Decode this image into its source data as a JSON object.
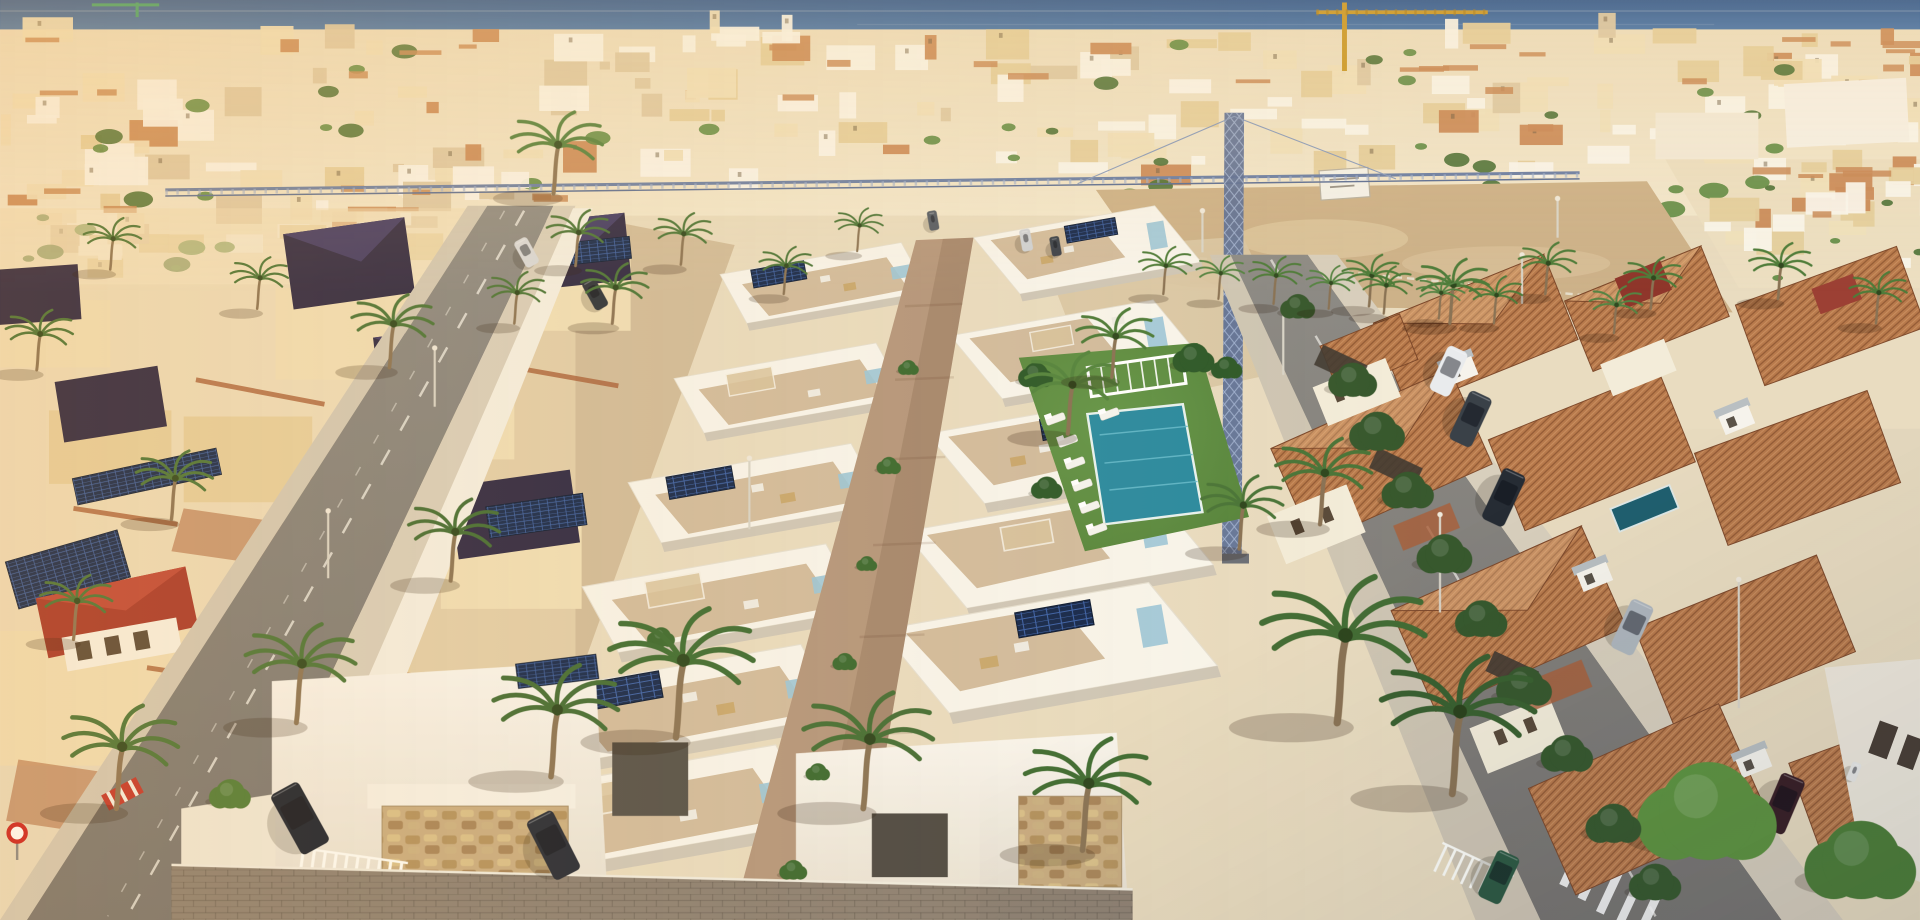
{
  "meta": {
    "kind": "aerial-architectural-render",
    "description": "Aerial drone view at golden hour of a new-build development of white modern townhouses with roof terraces, solar panels and a communal pool, flanked by an older district of cream villas with dark hip roofs on the left and Mediterranean villas with terracotta tiled roofs on the right; palm-lined streets, a sandy vacant lot with a tower crane, dense white town and the deep blue sea on the horizon.",
    "width": 1920,
    "height": 920
  },
  "palette": {
    "sea1": "#2b5793",
    "sea2": "#5082b8",
    "band1": "#ecdfc2",
    "band2": "#f2e7cd",
    "sand": "#cdb28a",
    "sand_light": "#dcc59e",
    "white_wall": "#f8f5ec",
    "shade_wall": "#cfc7b8",
    "cream": "#f0dfb8",
    "cream2": "#e6d0a0",
    "terrace_tan": "#d2bc9e",
    "path_tan": "#b5977d",
    "drive_tan": "#d9c6a4",
    "lawn": "#54813a",
    "lawn_light": "#66974a",
    "pool": "#2c8ba0",
    "pool_ripple": "#67bccd",
    "pool_private": "#20606f",
    "glass_blue": "#9cc6d8",
    "solar": "#16294d",
    "solar_grid": "#3d62a8",
    "roof_navy": "#2d2845",
    "roof_navy_hi": "#413a66",
    "roof_red": "#a8392d",
    "roof_terra": "#b87a4c",
    "roof_terra_dark": "#7e4a2c",
    "gable_red": "#8f362b",
    "asphalt": "#8d8b86",
    "asphalt_dark": "#787571",
    "sidewalk": "#d2c9b7",
    "sidewalk2": "#d8cfbd",
    "stone": "#c9ad82",
    "brick": "#a9603a",
    "palm_trunk": "#8a7355",
    "crane_blue": "#5c6f96",
    "crane_lattice": "#9fb0cf",
    "crane_yellow": "#c9992a",
    "paver": "#8d8174",
    "sign_red": "#cc2222"
  },
  "scene": {
    "objects": [
      "sea-horizon",
      "distant-town",
      "tower-crane",
      "sandy-vacant-lot",
      "left-villa-district",
      "left-street",
      "new-development-row-west",
      "new-development-row-east",
      "central-walkway",
      "communal-garden",
      "swimming-pool",
      "pergola",
      "sun-loungers",
      "right-street",
      "right-villa-district",
      "private-pool",
      "crosswalks",
      "parked-cars",
      "street-lamps",
      "palm-trees",
      "stone-clad-walls",
      "solar-panels"
    ],
    "distant_town": {
      "seed": 7,
      "bands": [
        {
          "x": 0,
          "w": 1568,
          "y": 26,
          "h": 130,
          "count": 150
        },
        {
          "x": 0,
          "w": 440,
          "y": 150,
          "h": 78,
          "count": 45
        },
        {
          "x": 1360,
          "w": 208,
          "y": 135,
          "h": 95,
          "count": 25
        }
      ],
      "colors": [
        [
          "#f9f5ec",
          0.38
        ],
        [
          "#efe0bd",
          0.24
        ],
        [
          "#e4cf9e",
          0.14
        ],
        [
          "#c98a5a",
          0.09
        ],
        [
          "#dcc9a6",
          0.15
        ]
      ],
      "green1": "#4a7036",
      "green2": "#5d8a43",
      "terra": "#c88a58"
    },
    "development": {
      "rows": [
        {
          "protos": [
            "unit-west-solar",
            "unit-west-plain"
          ],
          "start": [
            736,
            198
          ],
          "step": [
            -20.5,
            82
          ],
          "scale0": 1,
          "dscale": 0.115,
          "count": 6
        },
        {
          "protos": [
            "unit-east-solar",
            "unit-east-plain"
          ],
          "start": [
            795,
            194
          ],
          "step": [
            -19,
            80
          ],
          "scale0": 1,
          "dscale": 0.12,
          "count": 5
        }
      ]
    },
    "palms": [
      [
        552,
        602,
        1.5,
        "#3f6d33"
      ],
      [
        705,
        660,
        1.35,
        "#466f36"
      ],
      [
        884,
        694,
        1.3,
        "#3f6d33"
      ],
      [
        242,
        590,
        1.15,
        "#4a7539"
      ],
      [
        450,
        634,
        1.3,
        "#436d35"
      ],
      [
        95,
        660,
        1.2,
        "#4a7539"
      ],
      [
        452,
        158,
        0.95,
        "#52803f"
      ],
      [
        500,
        264,
        0.7,
        "#4a7539"
      ],
      [
        556,
        216,
        0.6,
        "#4a7539"
      ],
      [
        1092,
        590,
        1.7,
        "#436d35"
      ],
      [
        1186,
        648,
        1.6,
        "#3a6130"
      ],
      [
        1078,
        428,
        1.0,
        "#4a7539"
      ],
      [
        1012,
        448,
        0.85,
        "#4a7539"
      ],
      [
        872,
        354,
        0.95,
        "#55853f"
      ],
      [
        908,
        308,
        0.8,
        "#4e7c3a"
      ],
      [
        318,
        300,
        0.85,
        "#4a7539"
      ],
      [
        368,
        474,
        0.95,
        "#436d35"
      ],
      [
        140,
        424,
        0.8,
        "#4a7539"
      ],
      [
        60,
        522,
        0.75,
        "#4a7539"
      ],
      [
        1184,
        264,
        0.75,
        "#4e7c3a"
      ],
      [
        1262,
        240,
        0.6,
        "#4e7c3a"
      ],
      [
        1348,
        252,
        0.6,
        "#4e7c3a"
      ],
      [
        1452,
        244,
        0.65,
        "#4e7c3a"
      ],
      [
        1532,
        264,
        0.6,
        "#4e7c3a"
      ],
      [
        1118,
        250,
        0.6,
        "#4e7c3a"
      ],
      [
        950,
        240,
        0.55,
        "#4e7c3a"
      ],
      [
        995,
        244,
        0.5,
        "#558443"
      ],
      [
        1040,
        248,
        0.55,
        "#4e7c3a"
      ],
      [
        1085,
        252,
        0.5,
        "#558443"
      ],
      [
        1130,
        256,
        0.55,
        "#4e7c3a"
      ],
      [
        1175,
        260,
        0.5,
        "#558443"
      ],
      [
        1220,
        264,
        0.55,
        "#4e7c3a"
      ],
      [
        1318,
        272,
        0.55,
        "#558443"
      ],
      [
        470,
        217,
        0.65,
        "#4a7539"
      ],
      [
        420,
        264,
        0.6,
        "#4a7539"
      ],
      [
        30,
        302,
        0.7,
        "#4a7539"
      ],
      [
        210,
        252,
        0.6,
        "#4a7539"
      ],
      [
        90,
        220,
        0.6,
        "#4a7539"
      ],
      [
        640,
        240,
        0.55,
        "#4a7539"
      ],
      [
        700,
        205,
        0.5,
        "#4a7539"
      ]
    ],
    "trees": [
      [
        1395,
        662,
        40,
        "#5f9440"
      ],
      [
        1520,
        702,
        32,
        "#4e7f38"
      ],
      [
        1105,
        310,
        14,
        "#38592e"
      ],
      [
        1125,
        352,
        16,
        "#38592e"
      ],
      [
        1150,
        400,
        15,
        "#38592e"
      ],
      [
        1180,
        452,
        16,
        "#38592e"
      ],
      [
        1210,
        505,
        15,
        "#38592e"
      ],
      [
        1245,
        560,
        16,
        "#38592e"
      ],
      [
        1280,
        615,
        15,
        "#38592e"
      ],
      [
        1318,
        672,
        16,
        "#38592e"
      ],
      [
        1352,
        720,
        15,
        "#38592e"
      ],
      [
        846,
        306,
        10,
        "#2f5a2a"
      ],
      [
        975,
        292,
        12,
        "#2f5a2a"
      ],
      [
        1002,
        300,
        9,
        "#2f5a2a"
      ],
      [
        855,
        398,
        9,
        "#2f5a2a"
      ],
      [
        742,
        300,
        6,
        "#3c6a30"
      ],
      [
        726,
        380,
        7,
        "#3c6a30"
      ],
      [
        708,
        460,
        6,
        "#3c6a30"
      ],
      [
        690,
        540,
        7,
        "#3c6a30"
      ],
      [
        668,
        630,
        7,
        "#3c6a30"
      ],
      [
        648,
        710,
        8,
        "#3c6a30"
      ],
      [
        188,
        648,
        12,
        "#4f7c38"
      ],
      [
        540,
        520,
        8,
        "#3c6a30"
      ],
      [
        1060,
        250,
        10,
        "#38592e"
      ]
    ],
    "cars": [
      [
        245,
        668,
        56,
        26,
        -29,
        "#1a2230"
      ],
      [
        452,
        690,
        54,
        24,
        -27,
        "#252b37"
      ],
      [
        486,
        240,
        26,
        12,
        -29,
        "#2e343c"
      ],
      [
        430,
        206,
        24,
        12,
        -29,
        "#d8dadc"
      ],
      [
        838,
        196,
        18,
        9,
        -10,
        "#cfd2d6"
      ],
      [
        862,
        201,
        16,
        8,
        -10,
        "#3a414b"
      ],
      [
        762,
        180,
        16,
        8,
        -10,
        "#555c66"
      ],
      [
        1183,
        303,
        40,
        18,
        25,
        "#e9ebed"
      ],
      [
        1201,
        342,
        44,
        20,
        25,
        "#3a4148"
      ],
      [
        1228,
        406,
        46,
        20,
        25,
        "#262c34"
      ],
      [
        1333,
        512,
        44,
        20,
        25,
        "#aeb6bd"
      ],
      [
        1456,
        656,
        48,
        21,
        23,
        "#3a2026"
      ],
      [
        1224,
        716,
        42,
        20,
        25,
        "#2e5a43"
      ],
      [
        1514,
        630,
        16,
        8,
        22,
        "#e9e9e6"
      ]
    ],
    "lamps": [
      [
        355,
        332,
        48
      ],
      [
        268,
        472,
        55
      ],
      [
        612,
        432,
        58
      ],
      [
        1048,
        306,
        55
      ],
      [
        1176,
        500,
        80
      ],
      [
        1420,
        578,
        105
      ],
      [
        1243,
        248,
        40
      ],
      [
        982,
        206,
        34
      ],
      [
        1272,
        194,
        32
      ]
    ],
    "loungers": [
      [
        872,
        360,
        -20
      ],
      [
        878,
        378,
        -20
      ],
      [
        884,
        396,
        -20
      ],
      [
        890,
        414,
        -20
      ],
      [
        896,
        432,
        -20
      ],
      [
        862,
        342,
        -20
      ],
      [
        906,
        338,
        -20
      ]
    ]
  }
}
